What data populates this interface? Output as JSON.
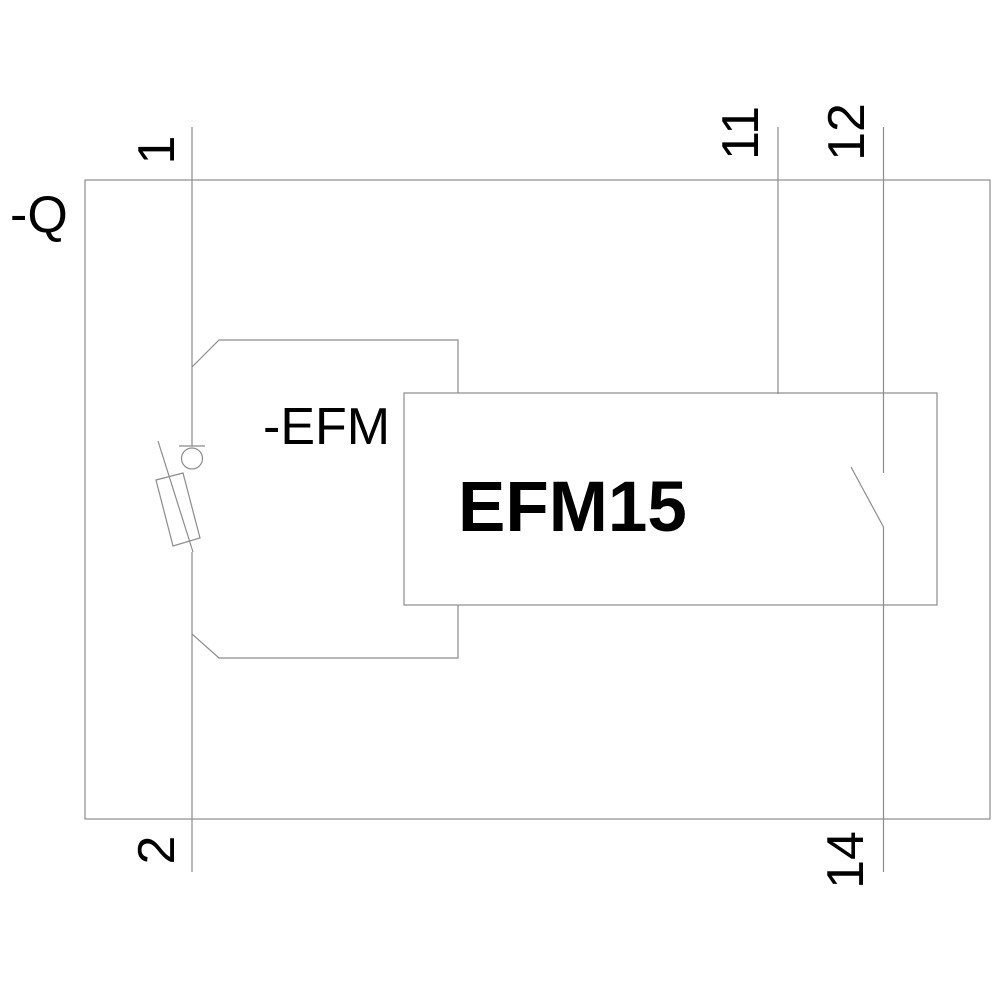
{
  "diagram": {
    "device_label": "-Q",
    "module_label": "-EFM",
    "module_name": "EFM15",
    "terminals": {
      "t1": "1",
      "t2": "2",
      "t11": "11",
      "t12": "12",
      "t14": "14"
    },
    "colors": {
      "line": "#8c8c8c",
      "text": "#000000",
      "background": "#ffffff"
    }
  }
}
